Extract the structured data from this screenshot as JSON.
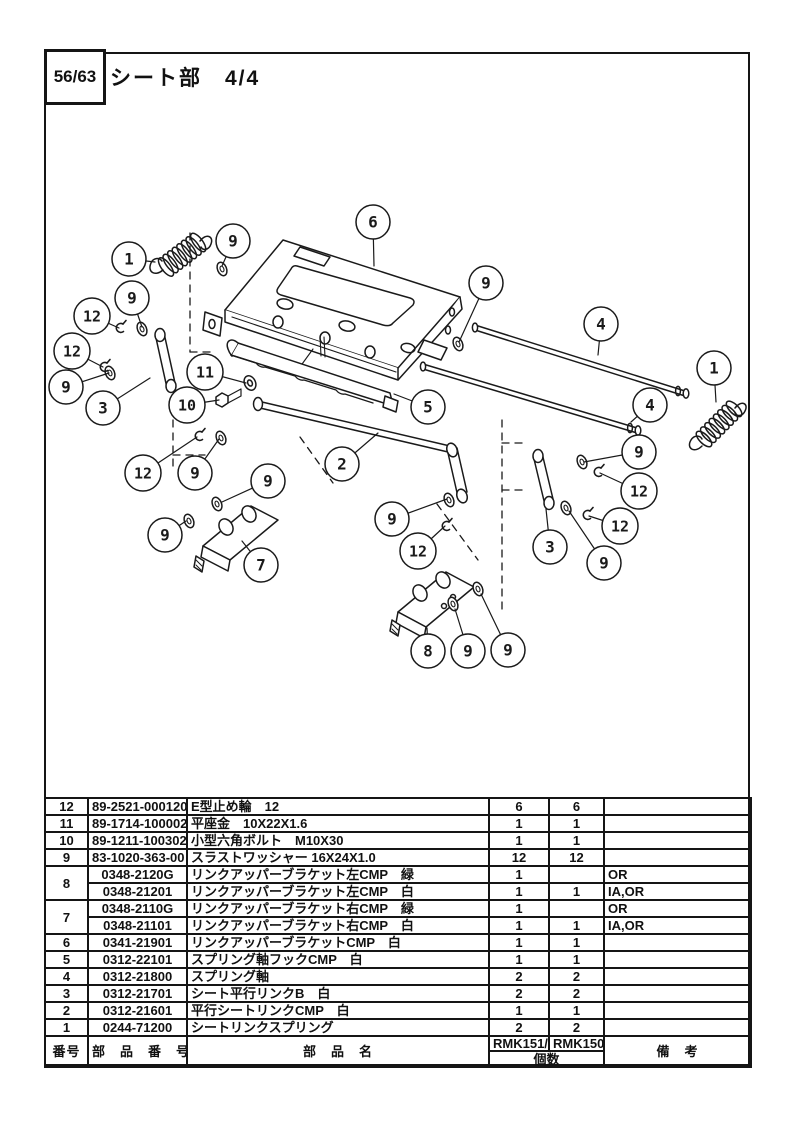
{
  "header": {
    "page_number": "56/63",
    "title": "シート部　4/4"
  },
  "diagram": {
    "callouts": [
      {
        "n": "1",
        "cx": 129,
        "cy": 259,
        "lx": 155,
        "ly": 262
      },
      {
        "n": "9",
        "cx": 233,
        "cy": 241,
        "lx": 222,
        "ly": 266
      },
      {
        "n": "6",
        "cx": 373,
        "cy": 222,
        "lx": 374,
        "ly": 266
      },
      {
        "n": "9",
        "cx": 132,
        "cy": 298,
        "lx": 142,
        "ly": 327
      },
      {
        "n": "12",
        "cx": 92,
        "cy": 316,
        "lx": 119,
        "ly": 328
      },
      {
        "n": "12",
        "cx": 72,
        "cy": 351,
        "lx": 103,
        "ly": 367
      },
      {
        "n": "9",
        "cx": 66,
        "cy": 387,
        "lx": 109,
        "ly": 373
      },
      {
        "n": "3",
        "cx": 103,
        "cy": 408,
        "lx": 150,
        "ly": 378
      },
      {
        "n": "11",
        "cx": 205,
        "cy": 372,
        "lx": 246,
        "ly": 383
      },
      {
        "n": "10",
        "cx": 187,
        "cy": 405,
        "lx": 219,
        "ly": 400
      },
      {
        "n": "5",
        "cx": 428,
        "cy": 407,
        "lx": 394,
        "ly": 394
      },
      {
        "n": "9",
        "cx": 486,
        "cy": 283,
        "lx": 459,
        "ly": 342
      },
      {
        "n": "4",
        "cx": 601,
        "cy": 324,
        "lx": 598,
        "ly": 355
      },
      {
        "n": "1",
        "cx": 714,
        "cy": 368,
        "lx": 716,
        "ly": 402
      },
      {
        "n": "4",
        "cx": 650,
        "cy": 405,
        "lx": 631,
        "ly": 422
      },
      {
        "n": "9",
        "cx": 639,
        "cy": 452,
        "lx": 584,
        "ly": 462
      },
      {
        "n": "12",
        "cx": 639,
        "cy": 491,
        "lx": 600,
        "ly": 473
      },
      {
        "n": "12",
        "cx": 620,
        "cy": 526,
        "lx": 589,
        "ly": 516
      },
      {
        "n": "3",
        "cx": 550,
        "cy": 547,
        "lx": 546,
        "ly": 509
      },
      {
        "n": "9",
        "cx": 604,
        "cy": 563,
        "lx": 569,
        "ly": 511
      },
      {
        "n": "2",
        "cx": 342,
        "cy": 464,
        "lx": 378,
        "ly": 433
      },
      {
        "n": "12",
        "cx": 143,
        "cy": 473,
        "lx": 197,
        "ly": 437
      },
      {
        "n": "9",
        "cx": 195,
        "cy": 473,
        "lx": 219,
        "ly": 439
      },
      {
        "n": "9",
        "cx": 268,
        "cy": 481,
        "lx": 222,
        "ly": 502
      },
      {
        "n": "9",
        "cx": 165,
        "cy": 535,
        "lx": 186,
        "ly": 521
      },
      {
        "n": "7",
        "cx": 261,
        "cy": 565,
        "lx": 242,
        "ly": 541
      },
      {
        "n": "9",
        "cx": 392,
        "cy": 519,
        "lx": 447,
        "ly": 499
      },
      {
        "n": "12",
        "cx": 418,
        "cy": 551,
        "lx": 445,
        "ly": 526
      },
      {
        "n": "8",
        "cx": 428,
        "cy": 651,
        "lx": 427,
        "ly": 628
      },
      {
        "n": "9",
        "cx": 468,
        "cy": 651,
        "lx": 455,
        "ly": 609
      },
      {
        "n": "9",
        "cx": 508,
        "cy": 650,
        "lx": 481,
        "ly": 594
      }
    ],
    "washers": [
      [
        222,
        269
      ],
      [
        142,
        329
      ],
      [
        110,
        373
      ],
      [
        458,
        344
      ],
      [
        582,
        462
      ],
      [
        566,
        508
      ],
      [
        221,
        438
      ],
      [
        217,
        504
      ],
      [
        189,
        521
      ],
      [
        449,
        500
      ],
      [
        453,
        604
      ],
      [
        478,
        589
      ]
    ],
    "clips": [
      [
        120,
        328
      ],
      [
        104,
        367
      ],
      [
        199,
        436
      ],
      [
        598,
        472
      ],
      [
        587,
        515
      ],
      [
        446,
        526
      ]
    ]
  },
  "table": {
    "rows": [
      {
        "no": "12",
        "part_no": "89-2521-000120",
        "name": "E型止め輪　12",
        "qty_a": "6",
        "qty_b": "6",
        "remarks": ""
      },
      {
        "no": "11",
        "part_no": "89-1714-100002",
        "name": "平座金　10X22X1.6",
        "qty_a": "1",
        "qty_b": "1",
        "remarks": ""
      },
      {
        "no": "10",
        "part_no": "89-1211-100302",
        "name": "小型六角ボルト　M10X30",
        "qty_a": "1",
        "qty_b": "1",
        "remarks": ""
      },
      {
        "no": "9",
        "part_no": "83-1020-363-00",
        "name": "スラストワッシャー 16X24X1.0",
        "qty_a": "12",
        "qty_b": "12",
        "remarks": ""
      },
      {
        "no": "8",
        "rowspan": 2,
        "part_no": "0348-2120G",
        "name": "リンクアッパーブラケット左CMP　緑",
        "qty_a": "1",
        "qty_b": "",
        "remarks": "OR"
      },
      {
        "no": null,
        "part_no": "0348-21201",
        "name": "リンクアッパーブラケット左CMP　白",
        "qty_a": "1",
        "qty_b": "1",
        "remarks": "IA,OR"
      },
      {
        "no": "7",
        "rowspan": 2,
        "part_no": "0348-2110G",
        "name": "リンクアッパーブラケット右CMP　緑",
        "qty_a": "1",
        "qty_b": "",
        "remarks": "OR"
      },
      {
        "no": null,
        "part_no": "0348-21101",
        "name": "リンクアッパーブラケット右CMP　白",
        "qty_a": "1",
        "qty_b": "1",
        "remarks": "IA,OR"
      },
      {
        "no": "6",
        "part_no": "0341-21901",
        "name": "リンクアッパーブラケットCMP　白",
        "qty_a": "1",
        "qty_b": "1",
        "remarks": ""
      },
      {
        "no": "5",
        "part_no": "0312-22101",
        "name": "スプリング軸フックCMP　白",
        "qty_a": "1",
        "qty_b": "1",
        "remarks": ""
      },
      {
        "no": "4",
        "part_no": "0312-21800",
        "name": "スプリング軸",
        "qty_a": "2",
        "qty_b": "2",
        "remarks": ""
      },
      {
        "no": "3",
        "part_no": "0312-21701",
        "name": "シート平行リンクB　白",
        "qty_a": "2",
        "qty_b": "2",
        "remarks": ""
      },
      {
        "no": "2",
        "part_no": "0312-21601",
        "name": "平行シートリンクCMP　白",
        "qty_a": "1",
        "qty_b": "1",
        "remarks": ""
      },
      {
        "no": "1",
        "part_no": "0244-71200",
        "name": "シートリンクスプリング",
        "qty_a": "2",
        "qty_b": "2",
        "remarks": ""
      }
    ],
    "footer": {
      "col_no": "番号",
      "col_part_no": "部　品　番　号",
      "col_part_name": "部　品　名",
      "model_a": "RMK151/X",
      "model_b": "RMK150A",
      "qty_label": "個数",
      "col_remarks": "備　考"
    }
  }
}
